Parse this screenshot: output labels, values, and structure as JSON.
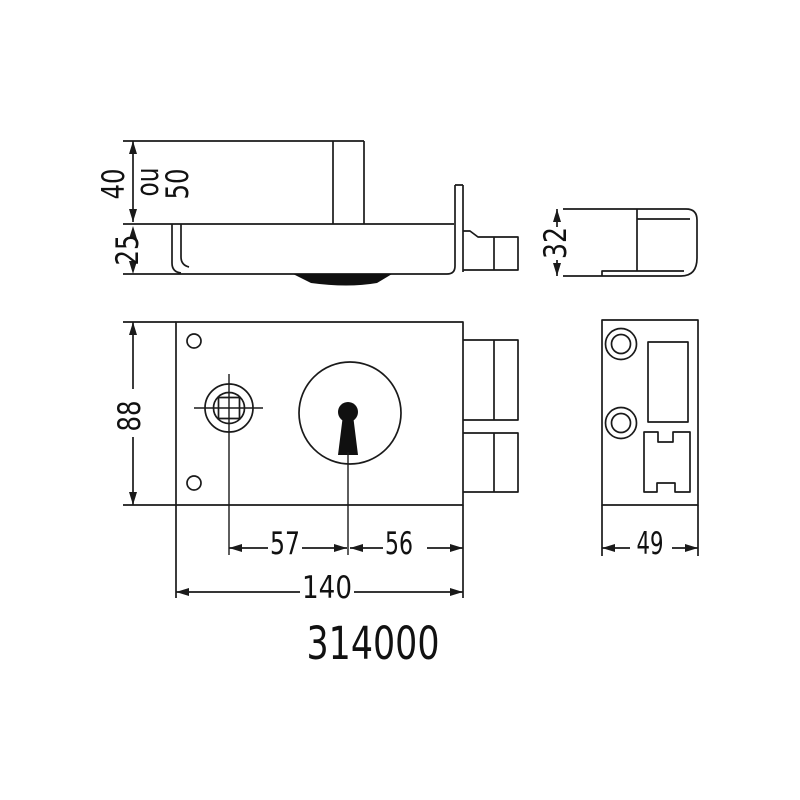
{
  "part_number": "314000",
  "dims": {
    "d40": "40",
    "ou": "ou",
    "d50": "50",
    "d25": "25",
    "d32": "32",
    "d88": "88",
    "d57": "57",
    "d56": "56",
    "d140": "140",
    "d49": "49"
  },
  "colors": {
    "line": "#1a1a1a",
    "background": "#ffffff"
  }
}
